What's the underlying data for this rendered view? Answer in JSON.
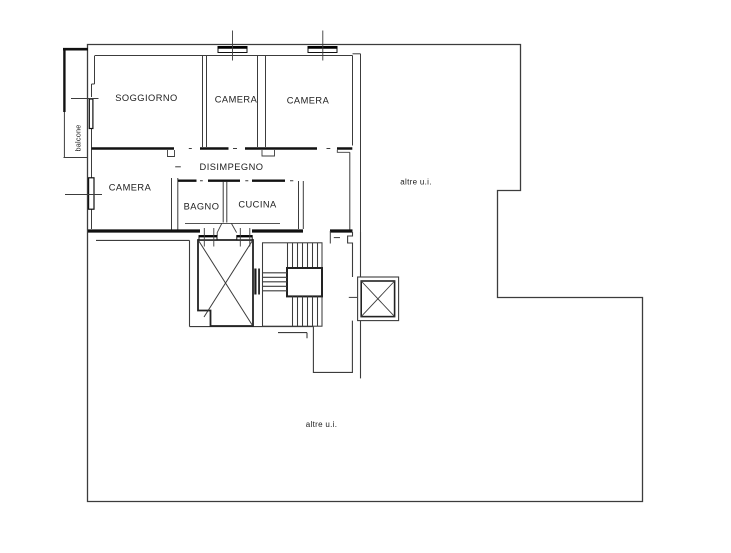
{
  "document": {
    "type": "floor-plan",
    "language": "it"
  },
  "colors": {
    "background": "#ffffff",
    "line_thin": "#3c3c3c",
    "line_wall": "#111111",
    "text": "#1c1c1c"
  },
  "plan": {
    "rooms": [
      {
        "id": "soggiorno",
        "label": "SOGGIORNO"
      },
      {
        "id": "camera-top-1",
        "label": "CAMERA"
      },
      {
        "id": "camera-top-2",
        "label": "CAMERA"
      },
      {
        "id": "camera-left",
        "label": "CAMERA"
      },
      {
        "id": "disimpegno",
        "label": "DISIMPEGNO"
      },
      {
        "id": "bagno",
        "label": "BAGNO"
      },
      {
        "id": "cucina",
        "label": "CUCINA"
      },
      {
        "id": "balcone",
        "label": "balcone"
      }
    ],
    "other_units": {
      "top_right": "altre u.i.",
      "bottom": "altre u.i."
    },
    "features": [
      "elevator-shaft-cross",
      "secondary-shaft-cross",
      "staircase-with-landing",
      "windows-with-tick-marks"
    ]
  }
}
